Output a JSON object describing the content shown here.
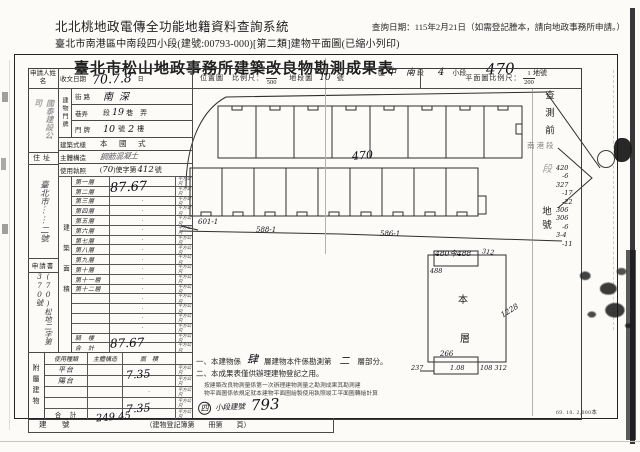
{
  "header": {
    "system_title": "北北桃地政電傳全功能地籍資料查詢系統",
    "query_date": "查詢日期：115年2月21日（如需登記謄本，請向地政事務所申請。）",
    "doc_line": "臺北市南港區中南段四小段(建號:00793-000)[第二類]建物平面圖(已縮小列印)"
  },
  "doc": {
    "title": "臺北市松山地政事務所建築改良物勘測成果表",
    "location": {
      "district_label": "區",
      "district_hand": "中",
      "section_hand": "南",
      "section_label": "段",
      "subsection_hand": "4",
      "subsection_label": "小段",
      "parcel_hand": "470",
      "parcel_label": "地號"
    },
    "scales": {
      "location_map_label": "位置圖　比例尺：",
      "location_scale_num": "1",
      "location_scale_den": "500",
      "sheet_label": "地段圖",
      "sheet_no": "10",
      "sheet_suffix": "號",
      "plan_scale_label": "平面圖比例尺：",
      "plan_scale_num": "1",
      "plan_scale_den": "200"
    }
  },
  "form": {
    "applicant_label": "申請人姓名",
    "applicant_name": "國泰建設公司",
    "receive_label": "收文日期",
    "receive_value": "70.7.8",
    "receive_suffix": "日",
    "door_vlabel": "建物門牌",
    "street_label": "街路",
    "street_value": "南深",
    "lane_label": "巷弄",
    "lane_pre": "段",
    "lane_hand": "19",
    "lane_post": "巷　弄",
    "plate_label": "門牌",
    "plate_hand1": "10",
    "plate_mid": "號",
    "plate_hand2": "2",
    "plate_post": "樓",
    "style_label": "建築式樣",
    "style_value": "本　國　式",
    "structure_label": "主體構造",
    "structure_value": "鋼筋混凝土",
    "license_label": "使用執照",
    "license_a": "(",
    "license_b": "70",
    "license_c": ")使字第",
    "license_d": "412",
    "license_e": "號",
    "residence_label": "住址",
    "residence_value": "臺北市⋮⋮二號",
    "application_label": "申請書",
    "application_no": "(70)松地二字第370號",
    "area_vlabel": "建築面積",
    "floors": [
      "第一層",
      "第二層",
      "第三層",
      "第四層",
      "第五層",
      "第六層",
      "第七層",
      "第八層",
      "第九層",
      "第十層",
      "第十一層",
      "第十二層"
    ],
    "floor2_value": "87.67",
    "arcade_label": "騎　樓",
    "total_label": "合　計",
    "total_value": "87.67",
    "unit": "平方公尺",
    "annex": {
      "vlabel": "附屬建物",
      "col_type": "使用種類",
      "col_structure": "主體構造",
      "col_area": "面　積",
      "row1_type": "平台",
      "row2_type": "陽台",
      "row2_area": "7.35",
      "total_label": "合　計",
      "total_area": "7.35"
    },
    "building_no_label": "建　號",
    "building_no_hand": "249.45",
    "register_note": "（建物登記簿第　　冊第　　頁）"
  },
  "plan": {
    "center_parcel": "470",
    "parcel_left": "601-1",
    "parcel_mid": "588-1",
    "parcel_right": "586-1"
  },
  "detail": {
    "floor_char1": "本",
    "floor_char2": "層",
    "dim_top": "480今488",
    "dim_top_right": "312",
    "dim_top_left": "488",
    "dim_right": "1228",
    "dim_b_top": "266",
    "dim_b_left": "237",
    "dim_b_inner": "1.08",
    "dim_b_right": "108 312"
  },
  "notes": {
    "l1a": "一、本建物係",
    "l1_hand1": "肆",
    "l1b": "層建物本件係勘測第",
    "l1_hand2": "二",
    "l1c": "層部分。",
    "l2": "二、本成果表僅供辦理建物登記之用。",
    "l3": "按建築改良物測量係第一次辦理建物測量之勘測成果其勘測建",
    "l4": "物平面圖係依規定就本建物平面圖繪製使用執照竣工平面圖轉繪計算",
    "stamp_circle": "四",
    "stamp_label": "小段建號",
    "stamp_no": "793"
  },
  "sidebar": {
    "pre_survey": "查測前",
    "stamp": "南港段",
    "hand_mark": "段",
    "parcel_label": "地號",
    "numbers": [
      "420",
      "-6",
      "327",
      "-17",
      "-22",
      "306",
      "306",
      "-6",
      "3-4",
      "-11"
    ]
  },
  "footer": {
    "print_info": "69. 10. 2,000本"
  }
}
